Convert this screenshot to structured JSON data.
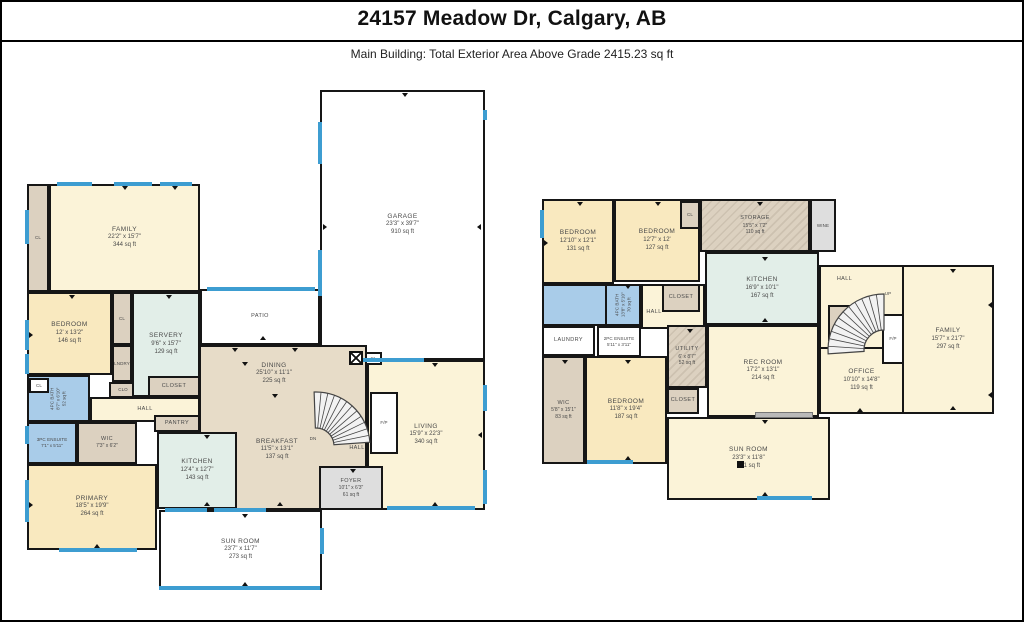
{
  "header": {
    "title": "24157 Meadow Dr, Calgary, AB",
    "subtitle": "Main Building: Total Exterior Area Above Grade 2415.23 sq ft"
  },
  "colors": {
    "wall": "#161616",
    "window": "#3D9DD1",
    "cream": "#FBF3D8",
    "warm": "#F9E9BF",
    "tan": "#E7DCC8",
    "taupe": "#DCD1C0",
    "green": "#E2EEE8",
    "blue": "#A9CCE9",
    "grey": "#DEDEDE",
    "white": "#FFFFFF"
  },
  "floors": [
    {
      "id": "main-floor",
      "rooms": [
        {
          "n": "CL",
          "x": 25,
          "y": 182,
          "w": 22,
          "h": 108,
          "c": "taupe",
          "s": "xxs"
        },
        {
          "n": "FAMILY",
          "d": "22'2\" x 15'7\"",
          "a": "344 sq ft",
          "x": 47,
          "y": 182,
          "w": 151,
          "h": 108,
          "c": "cream"
        },
        {
          "n": "GARAGE",
          "d": "23'3\" x 39'7\"",
          "a": "910 sq ft",
          "x": 318,
          "y": 88,
          "w": 165,
          "h": 270,
          "c": "white"
        },
        {
          "n": "PATIO",
          "x": 198,
          "y": 287,
          "w": 120,
          "h": 56,
          "c": "white",
          "s": "xs"
        },
        {
          "n": "",
          "x": 197,
          "y": 343,
          "w": 168,
          "h": 165,
          "c": "tan"
        },
        {
          "n": "BEDROOM",
          "d": "12' x 13'2\"",
          "a": "146 sq ft",
          "x": 25,
          "y": 290,
          "w": 85,
          "h": 83,
          "c": "warm"
        },
        {
          "n": "CL",
          "x": 110,
          "y": 290,
          "w": 20,
          "h": 53,
          "c": "taupe",
          "s": "xxs"
        },
        {
          "n": "LNDRY",
          "x": 110,
          "y": 343,
          "w": 20,
          "h": 37,
          "c": "taupe",
          "s": "xxs"
        },
        {
          "n": "CLO",
          "x": 107,
          "y": 380,
          "w": 28,
          "h": 16,
          "c": "taupe",
          "s": "xxs"
        },
        {
          "n": "SERVERY",
          "d": "9'6\" x 15'7\"",
          "a": "129 sq ft",
          "x": 130,
          "y": 290,
          "w": 68,
          "h": 105,
          "c": "green"
        },
        {
          "n": "CLOSET",
          "x": 146,
          "y": 374,
          "w": 52,
          "h": 21,
          "c": "taupe",
          "s": "xs"
        },
        {
          "n": "4PC BATH",
          "d": "8'7\" x 6'10\"",
          "a": "52 sq ft",
          "x": 25,
          "y": 373,
          "w": 63,
          "h": 47,
          "c": "blue",
          "v": true,
          "s": "xxs"
        },
        {
          "n": "CL",
          "x": 27,
          "y": 376,
          "w": 20,
          "h": 15,
          "c": "white",
          "s": "xxs"
        },
        {
          "n": "3PC ENSUITE",
          "d": "7'1\" x 5'11\"",
          "x": 25,
          "y": 420,
          "w": 50,
          "h": 42,
          "c": "blue",
          "s": "xxs"
        },
        {
          "n": "WIC",
          "d": "7'3\" x 6'2\"",
          "x": 75,
          "y": 420,
          "w": 60,
          "h": 42,
          "c": "taupe",
          "s": "xs"
        },
        {
          "n": "HALL",
          "x": 88,
          "y": 395,
          "w": 110,
          "h": 25,
          "c": "cream",
          "s": "xs"
        },
        {
          "n": "PANTRY",
          "x": 152,
          "y": 413,
          "w": 46,
          "h": 17,
          "c": "taupe",
          "s": "xs"
        },
        {
          "n": "KITCHEN",
          "d": "12'4\" x 12'7\"",
          "a": "143 sq ft",
          "x": 155,
          "y": 430,
          "w": 80,
          "h": 77,
          "c": "green"
        },
        {
          "n": "PRIMARY",
          "d": "18'5\" x 19'9\"",
          "a": "264 sq ft",
          "x": 25,
          "y": 462,
          "w": 130,
          "h": 86,
          "c": "warm"
        },
        {
          "n": "LIVING",
          "d": "15'9\" x 22'3\"",
          "a": "340 sq ft",
          "x": 365,
          "y": 358,
          "w": 118,
          "h": 150,
          "c": "cream"
        },
        {
          "n": "FOYER",
          "d": "10'1\" x 6'3\"",
          "a": "61 sq ft",
          "x": 317,
          "y": 464,
          "w": 64,
          "h": 44,
          "c": "grey",
          "s": "xs"
        },
        {
          "n": "SUN ROOM",
          "d": "23'7\" x 11'7\"",
          "a": "273 sq ft",
          "x": 157,
          "y": 508,
          "w": 163,
          "h": 80,
          "c": "white"
        },
        {
          "n": "F/P",
          "x": 368,
          "y": 390,
          "w": 28,
          "h": 62,
          "c": "white",
          "s": "xxs"
        },
        {
          "n": "CL",
          "x": 363,
          "y": 350,
          "w": 17,
          "h": 13,
          "c": "white",
          "s": "xxs"
        },
        {
          "n": "DINING",
          "d": "25'10\" x 11'1\"",
          "a": "225 sq ft",
          "x": 197,
          "y": 352,
          "w": 150,
          "h": 40,
          "lo": true
        },
        {
          "n": "BREAKFAST",
          "d": "11'5\" x 13'1\"",
          "a": "137 sq ft",
          "x": 210,
          "y": 428,
          "w": 130,
          "h": 40,
          "lo": true
        },
        {
          "n": "HALL",
          "x": 330,
          "y": 440,
          "w": 50,
          "h": 14,
          "lo": true,
          "s": "xs"
        },
        {
          "n": "DN",
          "x": 298,
          "y": 432,
          "w": 26,
          "h": 10,
          "lo": true,
          "s": "xxs"
        }
      ]
    },
    {
      "id": "lower-floor",
      "rooms": [
        {
          "n": "",
          "x": 817,
          "y": 263,
          "w": 85,
          "h": 85,
          "c": "cream"
        },
        {
          "n": "",
          "x": 639,
          "y": 282,
          "w": 64,
          "h": 45,
          "c": "cream"
        },
        {
          "n": "BEDROOM",
          "d": "12'10\" x 12'1\"",
          "a": "131 sq ft",
          "x": 540,
          "y": 197,
          "w": 72,
          "h": 85,
          "c": "warm"
        },
        {
          "n": "BEDROOM",
          "d": "12'7\" x 12'",
          "a": "127 sq ft",
          "x": 612,
          "y": 197,
          "w": 86,
          "h": 83,
          "c": "warm"
        },
        {
          "n": "CL",
          "x": 678,
          "y": 199,
          "w": 20,
          "h": 28,
          "c": "taupe",
          "s": "xxs"
        },
        {
          "n": "STORAGE",
          "d": "15'5\" x 7'2\"",
          "a": "110 sq ft",
          "x": 698,
          "y": 197,
          "w": 110,
          "h": 53,
          "c": "taupe",
          "hatch": true,
          "s": "xs"
        },
        {
          "n": "WINE",
          "x": 808,
          "y": 197,
          "w": 26,
          "h": 53,
          "c": "grey",
          "s": "xxs"
        },
        {
          "n": "KITCHEN",
          "d": "16'9\" x 10'1\"",
          "a": "167 sq ft",
          "x": 703,
          "y": 250,
          "w": 114,
          "h": 73,
          "c": "green"
        },
        {
          "n": "",
          "x": 540,
          "y": 282,
          "w": 65,
          "h": 42,
          "c": "blue"
        },
        {
          "n": "4PC BATH",
          "d": "13'8\" x 5'10\"",
          "a": "70 sq ft",
          "x": 603,
          "y": 282,
          "w": 36,
          "h": 42,
          "c": "blue",
          "v": true,
          "s": "xxs"
        },
        {
          "n": "CLOSET",
          "x": 660,
          "y": 282,
          "w": 38,
          "h": 28,
          "c": "taupe",
          "s": "xs"
        },
        {
          "n": "LAUNDRY",
          "x": 540,
          "y": 324,
          "w": 53,
          "h": 30,
          "c": "white",
          "s": "xs"
        },
        {
          "n": "2PC ENSUITE",
          "d": "5'11\" x 3'11\"",
          "x": 595,
          "y": 324,
          "w": 44,
          "h": 31,
          "c": "white",
          "s": "xxs"
        },
        {
          "n": "UTILITY",
          "d": "6' x 8'7\"",
          "a": "52 sq ft",
          "x": 665,
          "y": 323,
          "w": 40,
          "h": 63,
          "c": "taupe",
          "hatch": true,
          "s": "xs"
        },
        {
          "n": "WIC",
          "d": "5'8\" x 15'1\"",
          "a": "83 sq ft",
          "x": 540,
          "y": 354,
          "w": 43,
          "h": 108,
          "c": "taupe",
          "s": "xs"
        },
        {
          "n": "BEDROOM",
          "d": "11'8\" x 19'4\"",
          "a": "187 sq ft",
          "x": 583,
          "y": 354,
          "w": 82,
          "h": 108,
          "c": "warm"
        },
        {
          "n": "CLOSET",
          "x": 665,
          "y": 386,
          "w": 32,
          "h": 26,
          "c": "taupe",
          "s": "xs"
        },
        {
          "n": "REC ROOM",
          "d": "17'2\" x 13'1\"",
          "a": "214 sq ft",
          "x": 705,
          "y": 323,
          "w": 112,
          "h": 92,
          "c": "cream"
        },
        {
          "n": "STRG",
          "x": 826,
          "y": 303,
          "w": 32,
          "h": 36,
          "c": "taupe",
          "s": "xxs"
        },
        {
          "n": "OFFICE",
          "d": "10'10\" x 14'8\"",
          "a": "119 sq ft",
          "x": 817,
          "y": 345,
          "w": 85,
          "h": 67,
          "c": "cream"
        },
        {
          "n": "FAMILY",
          "d": "15'7\" x 21'7\"",
          "a": "297 sq ft",
          "x": 900,
          "y": 263,
          "w": 92,
          "h": 149,
          "c": "cream"
        },
        {
          "n": "SUN ROOM",
          "d": "23'3\" x 11'8\"",
          "a": "271 sq ft",
          "x": 665,
          "y": 415,
          "w": 163,
          "h": 83,
          "c": "cream"
        },
        {
          "n": "F/P",
          "x": 880,
          "y": 312,
          "w": 22,
          "h": 50,
          "c": "white",
          "s": "xxs"
        },
        {
          "n": "HALL",
          "x": 820,
          "y": 270,
          "w": 45,
          "h": 16,
          "lo": true,
          "s": "xs"
        },
        {
          "n": "HALL",
          "x": 622,
          "y": 304,
          "w": 60,
          "h": 14,
          "lo": true,
          "s": "xs"
        },
        {
          "n": "UP",
          "x": 872,
          "y": 286,
          "w": 28,
          "h": 12,
          "lo": true,
          "s": "xxs"
        }
      ]
    }
  ],
  "stairs": [
    {
      "label": "DN"
    },
    {
      "label": "UP"
    }
  ]
}
